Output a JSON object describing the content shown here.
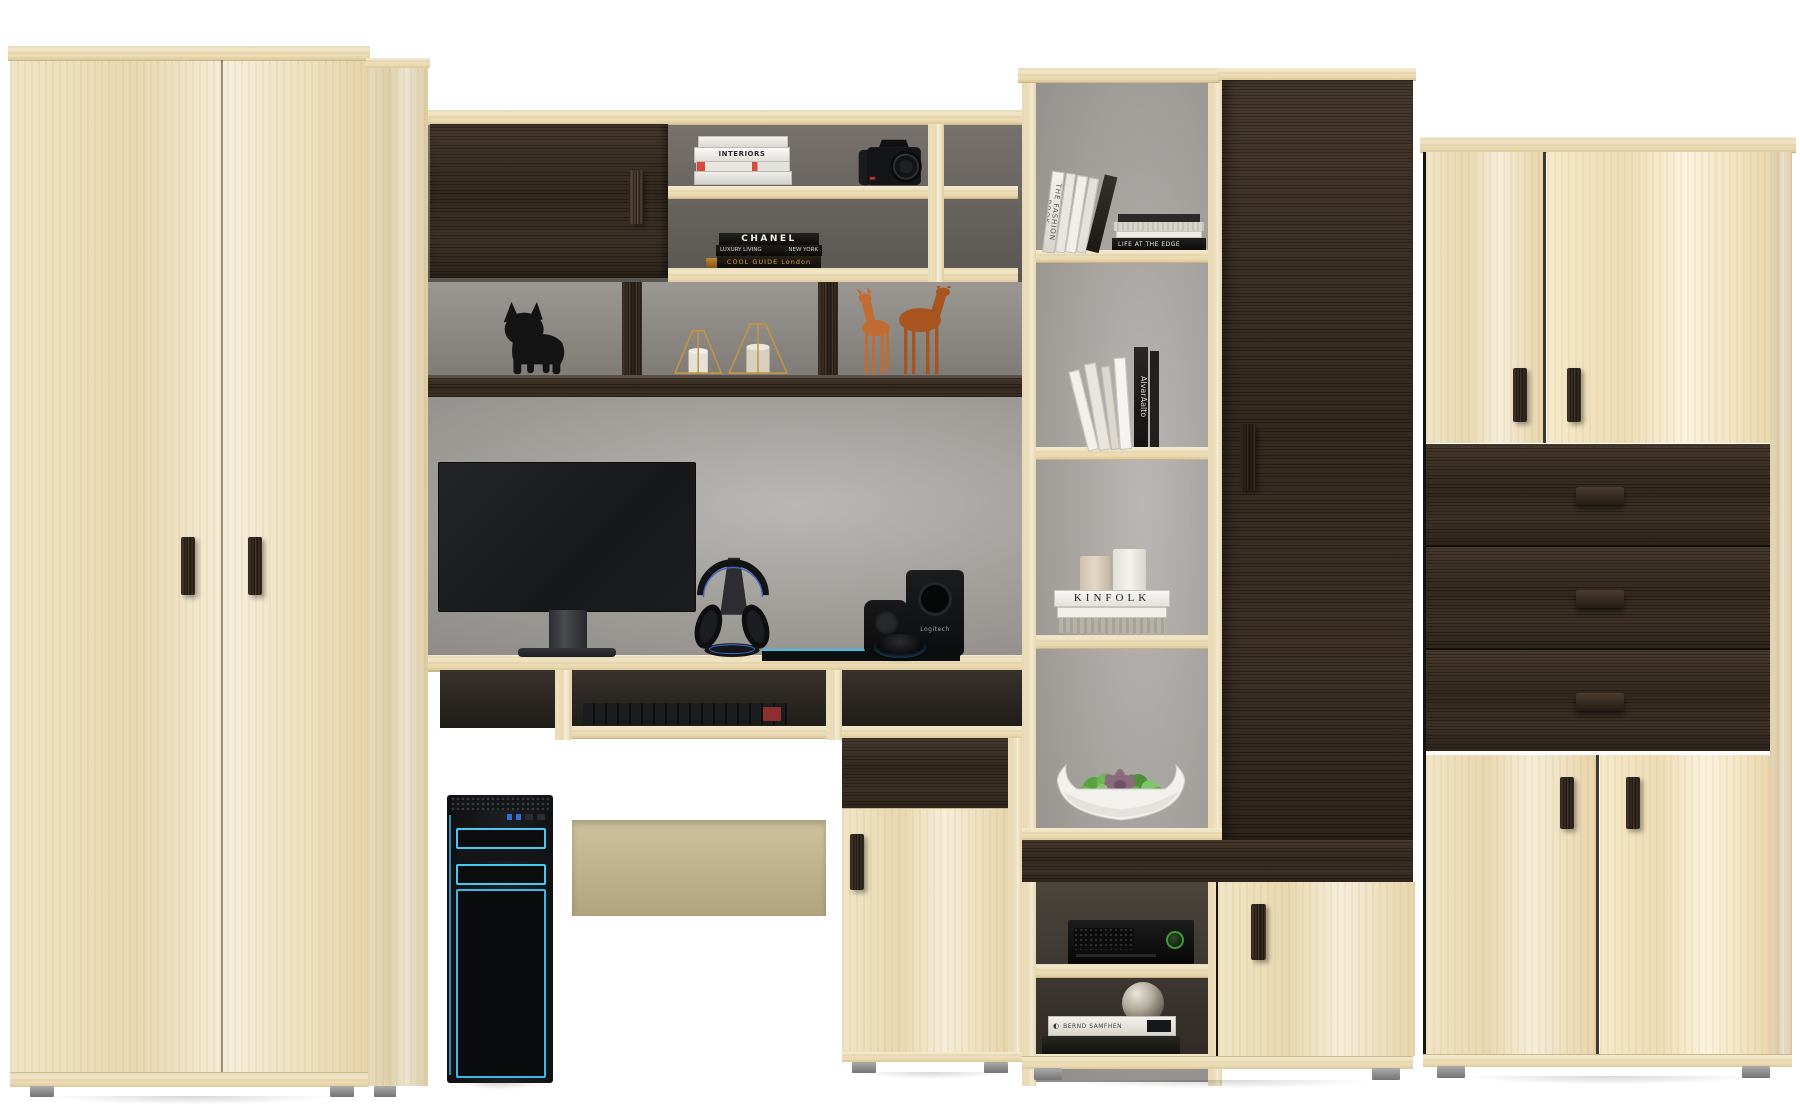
{
  "scene": {
    "type": "furniture-product-render",
    "subject": "Beige and dark-wenge wall unit: wardrobes, computer desk, open shelving, drawers and decor",
    "background": "#ffffff"
  },
  "palette": {
    "wood_light": "#eddfbc",
    "wood_dark_wenge": "#362c23",
    "back_panel_gray": "#8f8c89",
    "accent_cyan": "#41c4f0",
    "deer_terracotta": "#b05c2a",
    "succulent_green": "#63ac47",
    "succulent_purple": "#8a6a7d",
    "candle_frame_gold": "#c29544",
    "xbox_green": "#3f9b34"
  },
  "decor_text": {
    "interiors_stack": {
      "spine_2": "INTERIORS"
    },
    "chanel_stack": {
      "spine_1": "CHANEL",
      "spine_2_left": "LUXURY LIVING",
      "spine_2_right": "NEW YORK",
      "spine_3": "COOL GUIDE London"
    },
    "fashion_row": {
      "spine_1": "THE FASHION BOOK"
    },
    "edge_stack": {
      "spine_bottom": "LIFE AT THE EDGE"
    },
    "alvar_row": {
      "spine_black": "AlvarAalto"
    },
    "kinfolk_stack": {
      "spine_1": "KINFOLK"
    },
    "bottom_books": {
      "spine_white": "BERND SAMFHEN"
    },
    "subwoofer": {
      "logo": "Logitech"
    }
  }
}
